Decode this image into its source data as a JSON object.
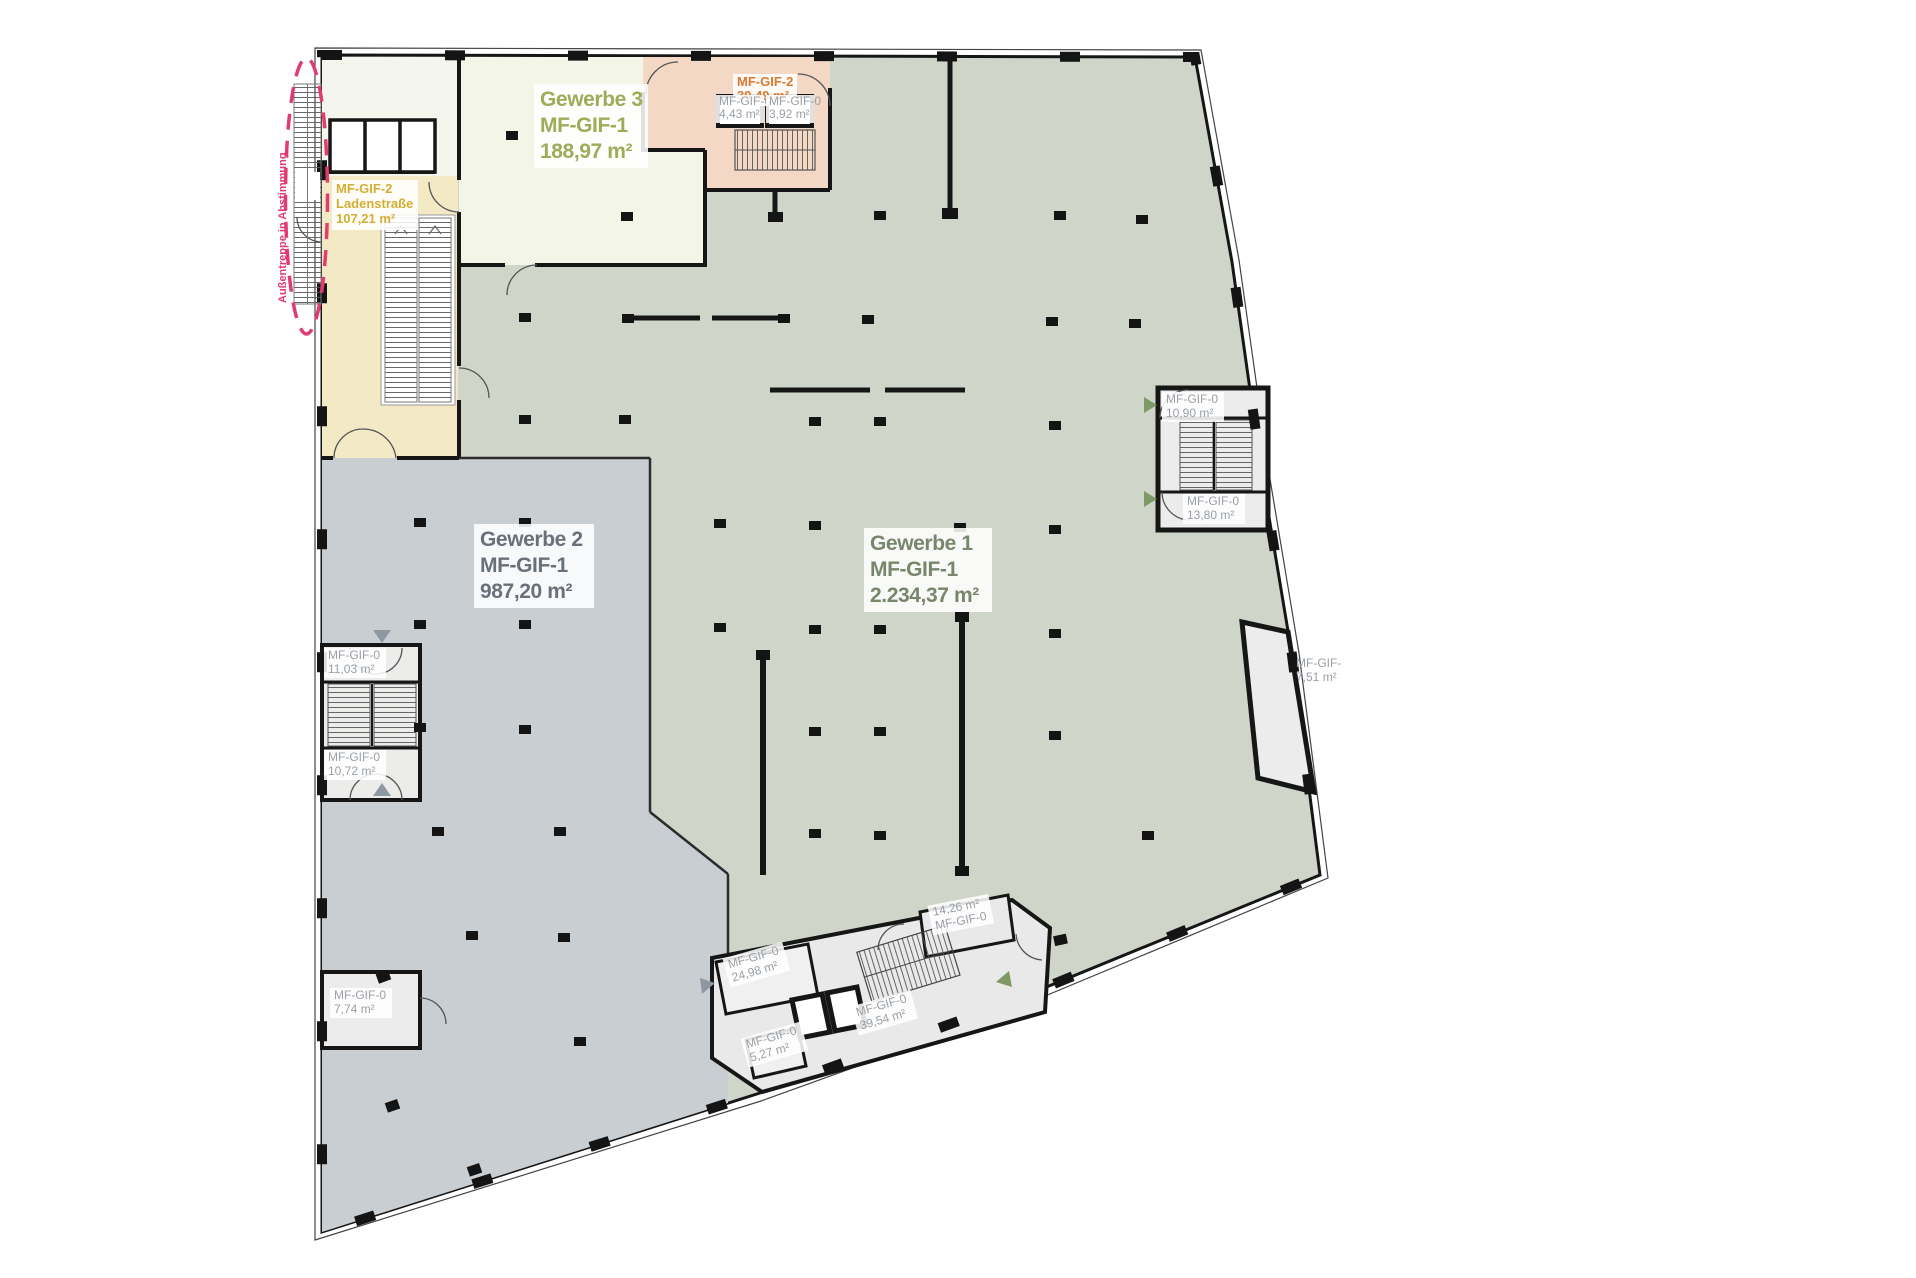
{
  "plan": {
    "regions": {
      "gewerbe1": {
        "name": "Gewerbe 1",
        "code": "MF-GIF-1",
        "area": "2.234,37 m²"
      },
      "gewerbe2": {
        "name": "Gewerbe 2",
        "code": "MF-GIF-1",
        "area": "987,20 m²"
      },
      "gewerbe3": {
        "name": "Gewerbe 3",
        "code": "MF-GIF-1",
        "area": "188,97 m²"
      },
      "ladenstrasse": {
        "code": "MF-GIF-2",
        "name": "Ladenstraße",
        "area": "107,21 m²"
      },
      "retail2": {
        "code": "MF-GIF-2",
        "area": "39,49 m²"
      }
    },
    "rooms": {
      "r443": {
        "code": "MF-GIF-0",
        "area": "4,43 m²"
      },
      "r392": {
        "code": "MF-GIF-0",
        "area": "3,92 m²"
      },
      "r1090": {
        "code": "MF-GIF-0",
        "area": "10,90 m²"
      },
      "r1380": {
        "code": "MF-GIF-0",
        "area": "13,80 m²"
      },
      "r1103": {
        "code": "MF-GIF-0",
        "area": "11,03 m²"
      },
      "r1072": {
        "code": "MF-GIF-0",
        "area": "10,72 m²"
      },
      "r774": {
        "code": "MF-GIF-0",
        "area": "7,74 m²"
      },
      "r751": {
        "code": "MF-GIF-",
        "area": "7,51 m²"
      },
      "r2498": {
        "code": "MF-GIF-0",
        "area": "24,98 m²"
      },
      "r1426": {
        "area": "14,26 m²",
        "code": "MF-GIF-0"
      },
      "r3954": {
        "code": "MF-GIF-0",
        "area": "39,54 m²"
      },
      "r527": {
        "code": "MF-GIF-0",
        "area": "5,27 m²"
      }
    },
    "annotations": {
      "aussentreppe": "Außentreppe in Abstimmung"
    },
    "colors": {
      "gewerbe1_fill": "#cfd5c9",
      "gewerbe2_fill": "#c9ced3",
      "gewerbe3_fill": "#f3f5e6",
      "whiteroom_fill": "#f4f5ec",
      "ladenstrasse_fill": "#f3eac5",
      "retail2_fill": "#f3d8c5",
      "core_fill": "#e9e9e9",
      "wall": "#161616",
      "gewerbe1_text": "#78866b",
      "gewerbe2_text": "#68717b",
      "gewerbe3_text": "#9fab58",
      "ladenstrasse_text": "#d3ae33",
      "retail2_text": "#d9792e",
      "small_label_text": "#9aa0a6",
      "annotation_pink": "#e23b70",
      "arrow_green": "#7d9a64",
      "arrow_gray": "#8d98a2"
    }
  }
}
